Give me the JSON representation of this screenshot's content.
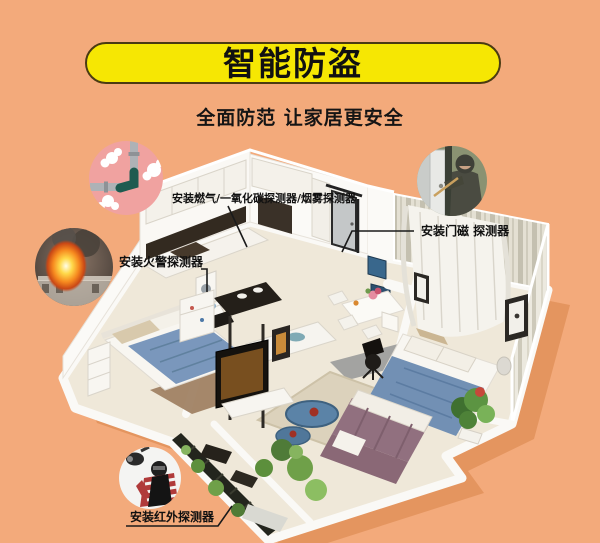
{
  "banner": {
    "title": "智能防盗",
    "bg_color": "#F6E703",
    "border_color": "#4A3B12"
  },
  "subtitle": "全面防范 让家居更安全",
  "background_color": "#F3AA7B",
  "callouts": {
    "gas": {
      "label": "安装燃气/一氧化碳探测器/烟雾探测器",
      "icon": "leaking-gas-pipe-illustration",
      "circle_color": "#F0A2A0"
    },
    "fire": {
      "label": "安装火警探测器",
      "icon": "house-fire-photo"
    },
    "door": {
      "label": "安装门磁 探测器",
      "icon": "burglar-prying-door-photo"
    },
    "infrared": {
      "label": "安装红外探测器",
      "icon": "burglar-and-security-camera-photo"
    }
  },
  "illustration": {
    "type": "isometric-apartment-cutaway",
    "accent_blue": "#7290B4",
    "sofa_mauve": "#91707F",
    "plant_green": "#5C9442"
  }
}
